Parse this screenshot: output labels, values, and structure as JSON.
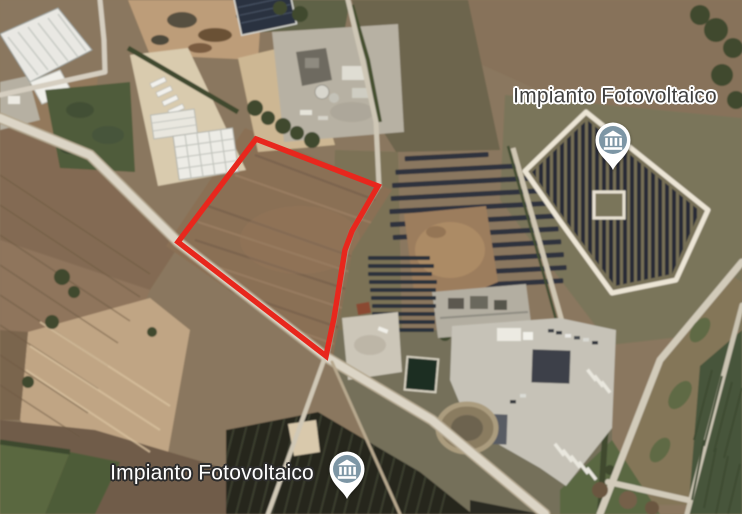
{
  "map": {
    "description": "satellite aerial view with annotated photovoltaic plant sites",
    "placemarks": [
      {
        "label": "Impianto Fotovoltaico",
        "label_style": "dark",
        "label_cx": 615,
        "label_cy": 96,
        "pin_tip_x": 613,
        "pin_tip_y": 170
      },
      {
        "label": "Impianto Fotovoltaico",
        "label_style": "light",
        "label_cx": 212,
        "label_cy": 473,
        "pin_tip_x": 347,
        "pin_tip_y": 499
      }
    ],
    "parcel": {
      "color": "#e8271d",
      "stroke_width": 5.5,
      "points": [
        [
          256,
          139
        ],
        [
          378,
          186
        ],
        [
          352,
          231
        ],
        [
          345,
          250
        ],
        [
          334,
          318
        ],
        [
          326,
          356
        ],
        [
          178,
          242
        ]
      ]
    },
    "pin": {
      "body": "#ffffff",
      "circle": "#7d96a5",
      "glyph": "government-building"
    }
  },
  "palette": {
    "label_dark": "#3f3f3f",
    "base_brown": "#8a775e",
    "field_brown": "#8a6f55",
    "field_dark": "#7a6550",
    "field_tan": "#c0a584",
    "pale_pad": "#d9cbae",
    "grass_olive": "#7a745a",
    "grass_dark": "#4f5c3b",
    "olive_field": "#6d654e",
    "hedge_green": "#42502f",
    "tree_green": "#3f4a2f",
    "road_light": "#dcd5c6",
    "road_mid": "#cfc7b6",
    "road_shoulder": "#b4a78f",
    "solar_panel": "#2d333d",
    "white_bld": "#e9e8e3",
    "pad_gray": "#b7b1a3",
    "lot_gray": "#c6c2b7",
    "bld_dark": "#3d4148",
    "mound_dirt": "#9c7d5d",
    "pond_dark": "#1d2e23",
    "track_white": "#ece5d5",
    "south_field_dark": "#25261f"
  }
}
